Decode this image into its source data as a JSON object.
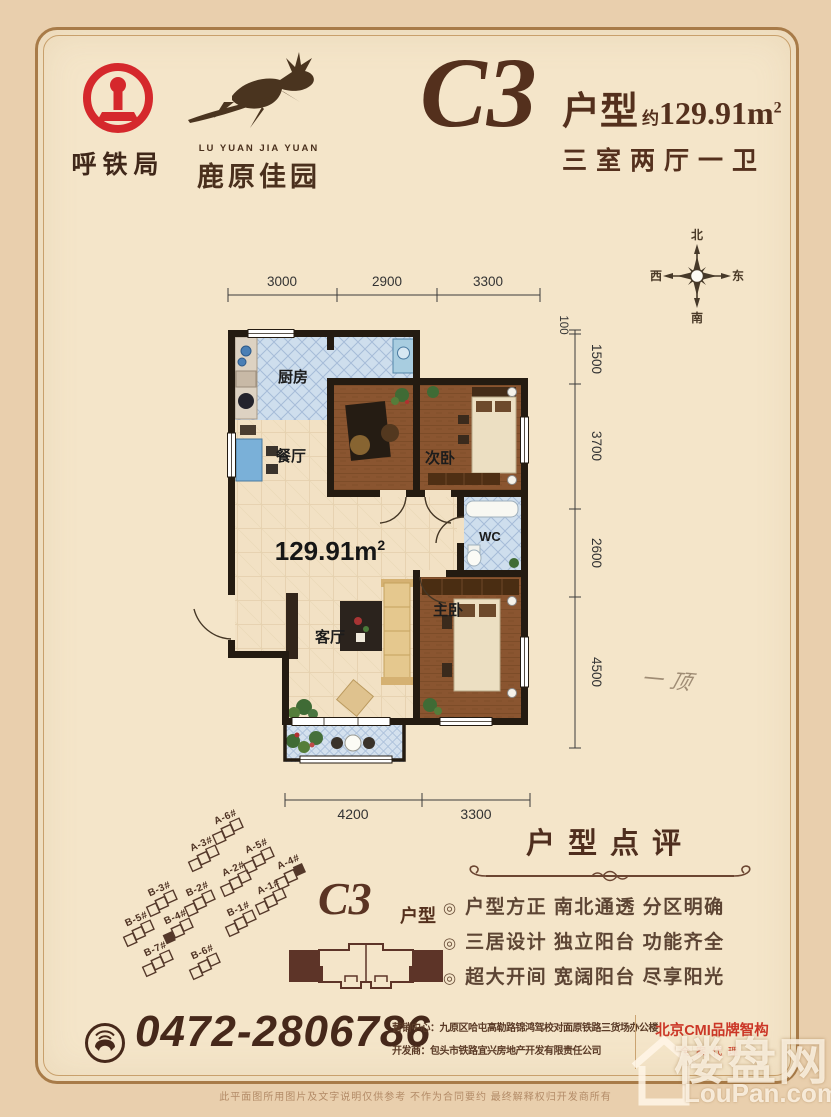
{
  "header": {
    "org_name": "呼铁局",
    "brand_en": "LU YUAN JIA YUAN",
    "brand_cn": "鹿原佳园",
    "unit_code": "C3",
    "unit_suffix": "户型",
    "area_approx_prefix": "约",
    "area_value": "129.91m",
    "area_sup": "2",
    "rooms_desc": "三室两厅一卫"
  },
  "compass": {
    "n": "北",
    "s": "南",
    "e": "东",
    "w": "西"
  },
  "floorplan": {
    "rooms": {
      "kitchen": "厨房",
      "dining": "餐厅",
      "bedroom2": "次卧",
      "wc": "WC",
      "living": "客厅",
      "master": "主卧"
    },
    "area_value": "129.91m",
    "area_sup": "2",
    "dims_top": [
      "3000",
      "2900",
      "3300"
    ],
    "dims_right": [
      "100",
      "1500",
      "3700",
      "2600",
      "4500"
    ],
    "dims_bottom": [
      "4200",
      "3300"
    ],
    "handwritten_note": "一顶"
  },
  "siteplan": {
    "buildings": [
      "A-6#",
      "A-3#",
      "A-5#",
      "A-4#",
      "A-2#",
      "A-1#",
      "B-3#",
      "B-2#",
      "B-1#",
      "B-5#",
      "B-4#",
      "B-7#",
      "B-6#"
    ],
    "unit_code": "C3",
    "unit_suffix": "户型"
  },
  "review": {
    "title": "户型点评",
    "bullet_marker": "◎",
    "bullets": [
      "户型方正 南北通透 分区明确",
      "三居设计 独立阳台 功能齐全",
      "超大开间 宽阔阳台 尽享阳光"
    ]
  },
  "footer": {
    "phone": "0472-2806786",
    "marketing_label": "营销中心：",
    "marketing_value": "九原区哈屯高勒路锦鸿驾校对面原铁路三货场办公楼",
    "developer_label": "开发商：",
    "developer_value": "包头市铁路宜兴房地产开发有限责任公司",
    "agency_name": "北京CMI品牌智构",
    "agency_sub": "全案代理",
    "disclaimer": "此平面图所用图片及文字说明仅供参考 不作为合同要约 最终解释权归开发商所有"
  },
  "watermark": {
    "cn": "楼盘网",
    "en": "LouPan.com"
  },
  "colors": {
    "page_bg": "#e9cfad",
    "panel_bg": "#f4e5c9",
    "frame_brown": "#a87b48",
    "title_brown": "#54301d",
    "rail_red": "#d5282c",
    "agency_red": "#cb3626",
    "wall_black": "#241b11"
  }
}
